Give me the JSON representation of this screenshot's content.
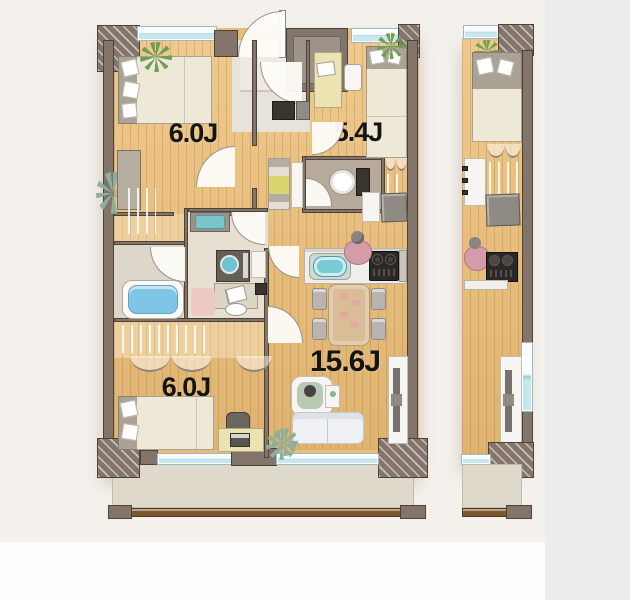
{
  "document": {
    "kind": "real-estate floor plan rendering",
    "orientation": "top-down 3D render",
    "visible_units": 2,
    "note_adjacent_unit": "identical neighbouring unit partially visible at right edge of image"
  },
  "units": {
    "main": {
      "rooms": [
        {
          "id": "bedroom-upper-left",
          "label": "6.0J"
        },
        {
          "id": "bedroom-upper-right",
          "label": "5.4J"
        },
        {
          "id": "living-dining-kitchen",
          "label": "15.6J"
        },
        {
          "id": "bedroom-lower-left",
          "label": "6.0J"
        }
      ],
      "fixtures": [
        "entrance-door",
        "meter-box",
        "shoe-cabinet",
        "double-bed",
        "single-bed",
        "desk",
        "office-chair",
        "toilet",
        "hand-wash-vanity",
        "bathtub",
        "washing-machine",
        "laundry-basket",
        "dressing-table",
        "stool",
        "kitchen-counter",
        "kitchen-sink",
        "gas-stove",
        "dining-table",
        "dining-chairs",
        "armchair",
        "sofa",
        "tv-board",
        "wall-tv",
        "walk-in-closet-hangers",
        "folding-closet-doors",
        "plants",
        "balcony",
        "balcony-railing",
        "sliding-windows"
      ],
      "people": [
        "person-at-desk",
        "person-cooking",
        "person-in-armchair"
      ]
    },
    "adjacent": {
      "visible_slice": [
        "window",
        "plant",
        "single-bed",
        "closet-hangers",
        "shelf",
        "wall-tv",
        "person-cooking",
        "gas-stove",
        "kitchen-counter",
        "tv-board",
        "balcony",
        "balcony-railing"
      ]
    }
  },
  "colors": {
    "background": "#f4f1ec",
    "background_right": "#eeedee",
    "wall": "#84756a",
    "wood_floor": "#e9bd79",
    "entrance_floor": "#e8e3da",
    "toilet_floor": "#b8aa9b",
    "bath_floor": "#ddd7cb",
    "balcony_floor": "#ded9cb",
    "window_glass": "#c6e6f0",
    "bathtub": "#7fc5e6",
    "railing": "#7e572f",
    "label_text": "#141414"
  }
}
